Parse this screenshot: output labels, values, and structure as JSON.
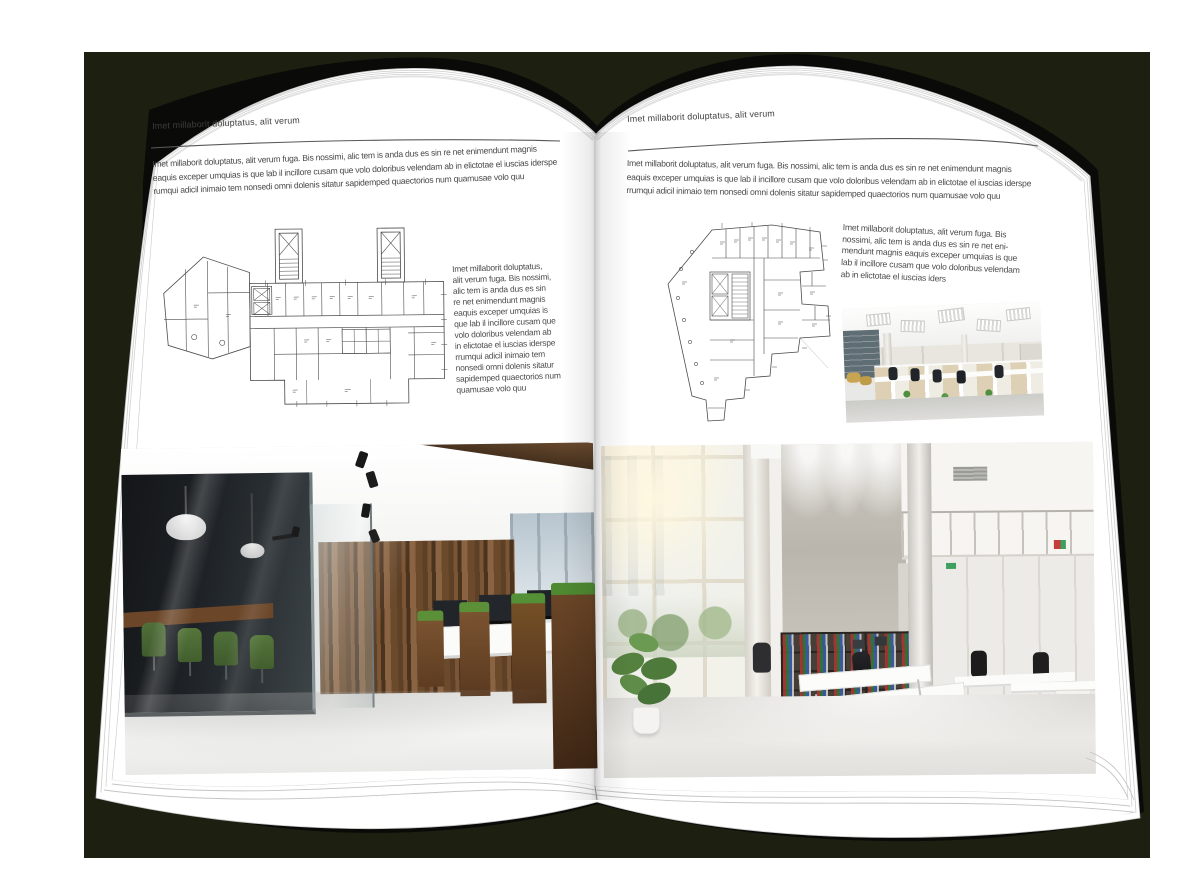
{
  "colors": {
    "backdrop": "#1d1f10",
    "cover": "#0a0a08",
    "page": "#ffffff",
    "text": "#4b4b4b",
    "wood_accent": "#6b4a2c",
    "plant_green": "#5c9038"
  },
  "left_page": {
    "header": "Imet millaborit doluptatus, alit verum",
    "intro_lines": [
      "Imet millaborit doluptatus, alit verum fuga. Bis nossimi, alic tem is anda dus es sin re net enimendunt magnis",
      "eaquis exceper umquias is que lab il incillore cusam que volo doloribus velendam ab in elictotae el iuscias iderspe",
      "rumqui adicil inimaio tem nonsedi omni dolenis sitatur sapidemped quaectorios num quamusae volo quu"
    ],
    "side_text_lines": [
      "Imet millaborit doluptatus,",
      "alit verum fuga. Bis nossimi,",
      "alic tem is anda dus es sin",
      "re net enimendunt magnis",
      "eaquis exceper umquias is",
      "que lab il incillore cusam que",
      "volo doloribus velendam ab",
      "in elictotae el iuscias iderspe",
      "rrumqui adicil inimaio tem",
      "nonsedi omni dolenis sitatur",
      "sapidemped quaectorios num",
      "quamusae volo quu"
    ],
    "figures": {
      "floor_plan": "architectural-floor-plan-wide-building",
      "photo": "office-interior-wood-and-glass"
    }
  },
  "right_page": {
    "header": "Imet millaborit doluptatus, alit verum",
    "intro_lines": [
      "Imet millaborit doluptatus, alit verum fuga. Bis nossimi, alic tem is anda dus es sin re net enimendunt magnis",
      "eaquis exceper umquias is que lab il incillore cusam que volo doloribus velendam ab in elictotae el iuscias iderspe",
      "rrumqui adicil inimaio tem nonsedi omni dolenis sitatur sapidemped quaectorios num quamusae volo quu"
    ],
    "side_text_lines": [
      "Imet millaborit doluptatus, alit verum fuga. Bis",
      "nossimi, alic tem is anda dus es sin re net eni-",
      "mendunt magnis eaquis exceper umquias is que",
      "lab il incillore cusam que volo doloribus velendam",
      "ab in elictotae el iuscias iders"
    ],
    "figures": {
      "floor_plan": "architectural-floor-plan-tower",
      "photo_small": "office-interior-cubicles",
      "photo_large": "office-interior-atrium"
    }
  }
}
